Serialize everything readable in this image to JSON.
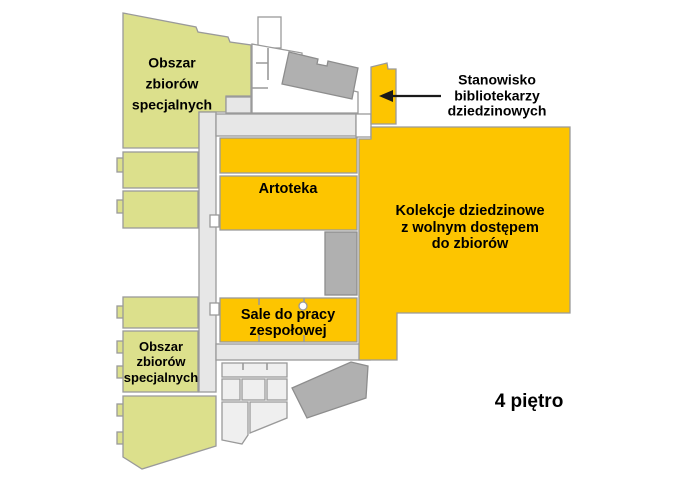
{
  "colors": {
    "open_access": "#FDC500",
    "special": "#DCE08C",
    "corridor": "#E7E7E7",
    "room_light": "#EFEFEF",
    "room_white": "#FFFFFF",
    "stairs": "#B0B0B0",
    "arrow": "#1A1A1A"
  },
  "labels": {
    "special_top": {
      "lines": [
        "Obszar",
        "zbiorów",
        "specjalnych"
      ]
    },
    "special_bottom": {
      "lines": [
        "Obszar",
        "zbiorów",
        "specjalnych"
      ]
    },
    "artoteka": "Artoteka",
    "kolekcje": {
      "lines": [
        "Kolekcje dziedzinowe",
        "z wolnym dostępem",
        "do zbiorów"
      ]
    },
    "sale": {
      "lines": [
        "Sale do pracy",
        "zespołowej"
      ]
    },
    "stanowisko": {
      "lines": [
        "Stanowisko",
        "bibliotekarzy",
        "dziedzinowych"
      ]
    },
    "floor": "4 piętro"
  }
}
